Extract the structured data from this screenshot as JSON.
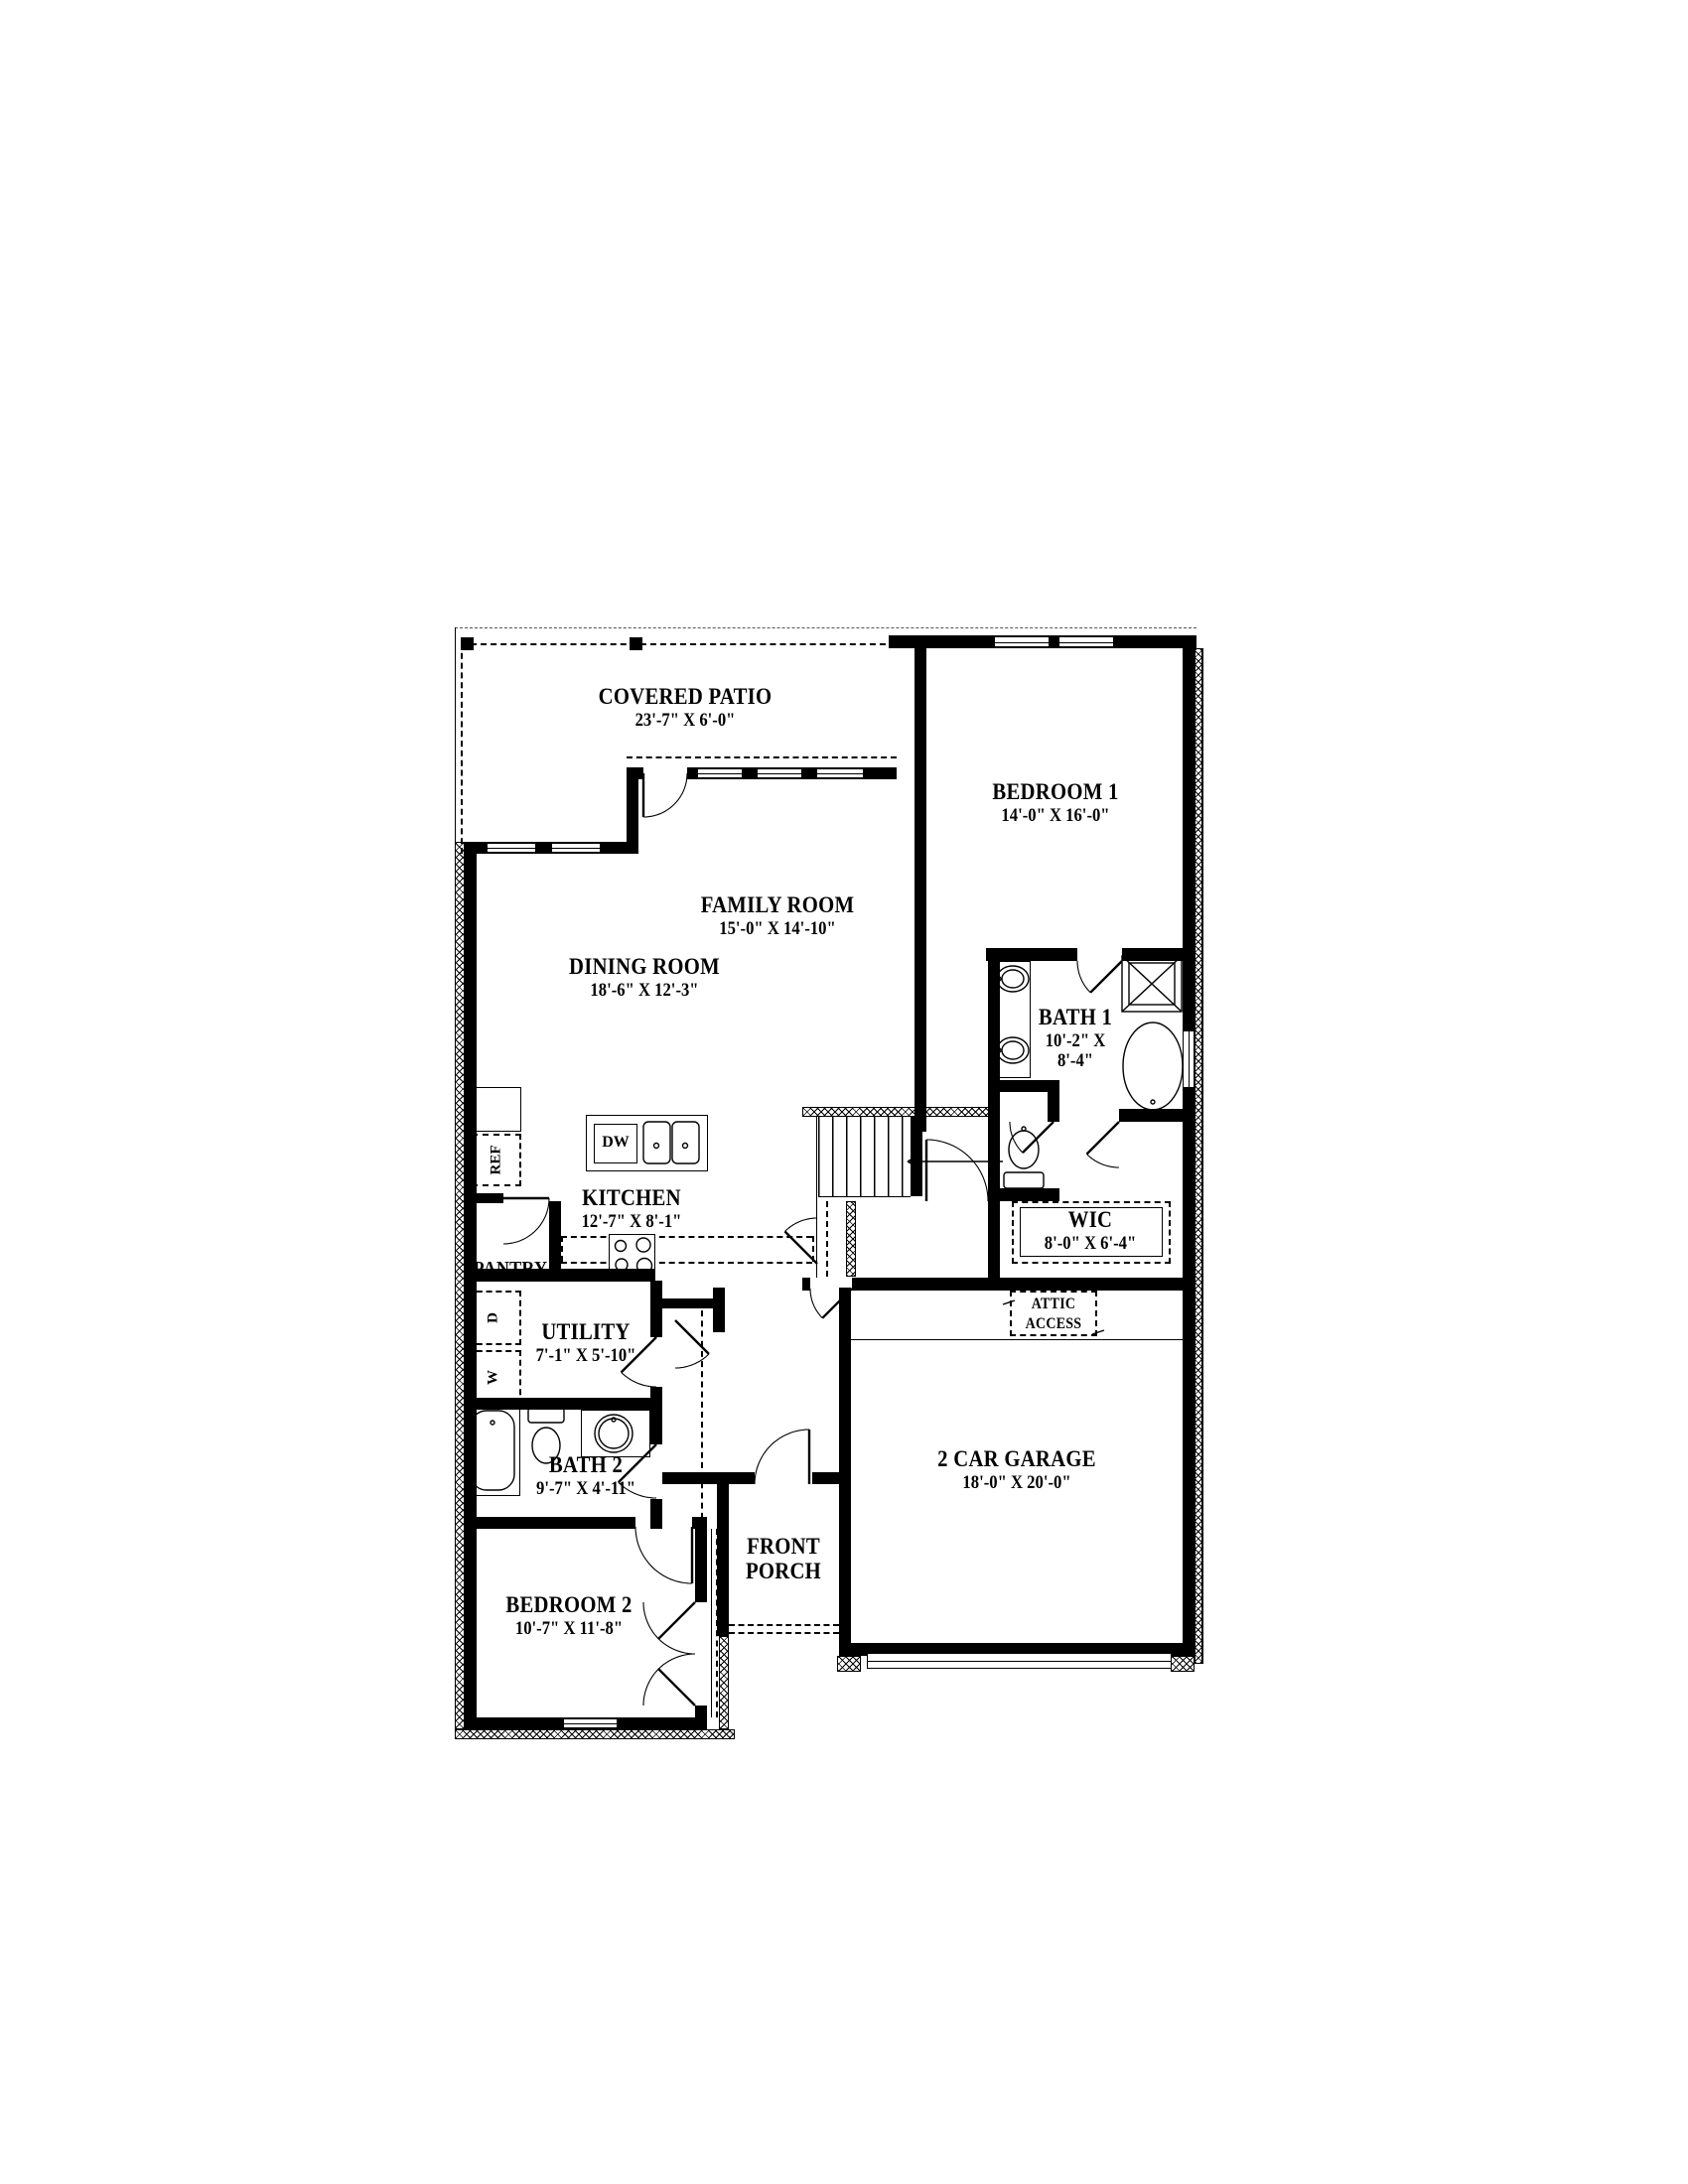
{
  "page": {
    "background": "#ffffff",
    "ink": "#000000"
  },
  "rooms": [
    {
      "id": "covered-patio",
      "name": "COVERED PATIO",
      "dims": "23'-7\" X 6'-0\""
    },
    {
      "id": "bedroom-1",
      "name": "BEDROOM 1",
      "dims": "14'-0\" X 16'-0\""
    },
    {
      "id": "family-room",
      "name": "FAMILY ROOM",
      "dims": "15'-0\" X 14'-10\""
    },
    {
      "id": "dining-room",
      "name": "DINING ROOM",
      "dims": "18'-6\" X 12'-3\""
    },
    {
      "id": "bath-1",
      "name": "BATH 1",
      "dims": "10'-2\" X 8'-4\""
    },
    {
      "id": "kitchen",
      "name": "KITCHEN",
      "dims": "12'-7\" X 8'-1\""
    },
    {
      "id": "pantry",
      "name": "PANTRY",
      "dims": ""
    },
    {
      "id": "utility",
      "name": "UTILITY",
      "dims": "7'-1\" X 5'-10\""
    },
    {
      "id": "bath-2",
      "name": "BATH 2",
      "dims": "9'-7\" X 4'-11\""
    },
    {
      "id": "bedroom-2",
      "name": "BEDROOM 2",
      "dims": "10'-7\" X 11'-8\""
    },
    {
      "id": "wic",
      "name": "WIC",
      "dims": "8'-0\" X 6'-4\""
    },
    {
      "id": "front-porch",
      "name": "FRONT PORCH",
      "dims": ""
    },
    {
      "id": "garage",
      "name": "2 CAR GARAGE",
      "dims": "18'-0\" X 20'-0\""
    },
    {
      "id": "attic-access",
      "name": "ATTIC ACCESS",
      "dims": ""
    }
  ],
  "appliances": {
    "dishwasher": "DW",
    "refrigerator": "REF",
    "washer": "W",
    "dryer": "D"
  }
}
